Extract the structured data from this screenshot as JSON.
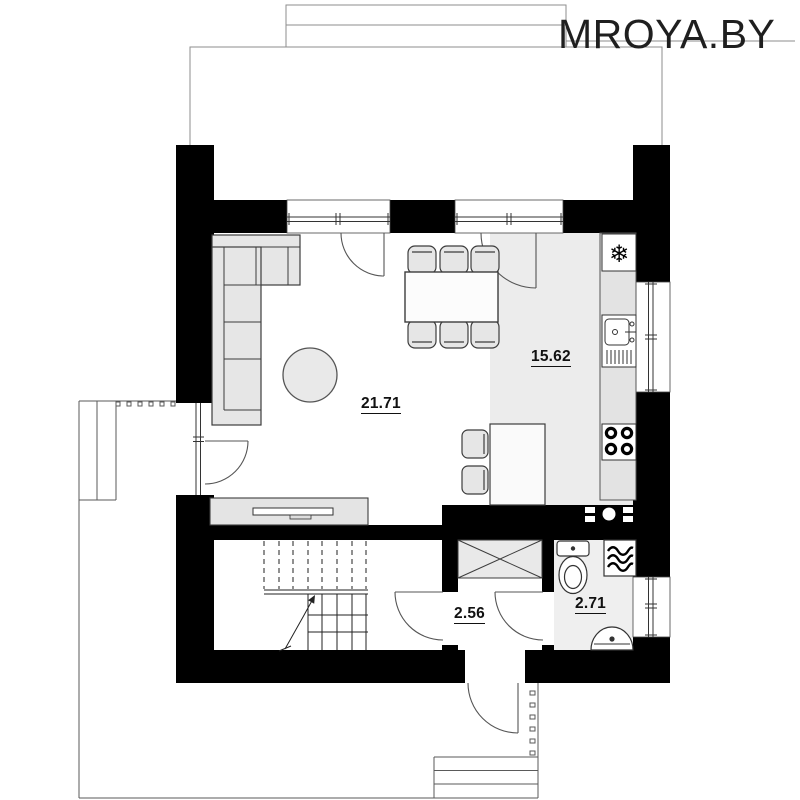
{
  "watermark": "MROYA.BY",
  "rooms": {
    "living_room": {
      "area": "21.71"
    },
    "kitchen": {
      "area": "15.62"
    },
    "hallway": {
      "area": "2.56"
    },
    "bathroom": {
      "area": "2.71"
    }
  },
  "icons": {
    "fridge": "❄"
  },
  "fixtures": [
    "corner-sofa",
    "coffee-table",
    "tv-stand",
    "dining-table",
    "dining-chairs",
    "kitchen-counter",
    "fridge",
    "kitchen-sink",
    "stove",
    "kitchen-island",
    "bar-stools",
    "wardrobe",
    "staircase",
    "toilet",
    "washing-machine",
    "washbasin",
    "vent-shaft",
    "entrance-steps",
    "terrace",
    "porch"
  ],
  "colors": {
    "wall": "#000000",
    "kitchen_floor": "#ececec",
    "bathroom_floor": "#efefef",
    "furniture_fill": "#e6e6e6",
    "furniture_stroke": "#3c3c3c",
    "roof_line": "#8e8e8e",
    "site_line": "#5a5a5a",
    "label_text": "#111111",
    "watermark_text": "#1f1f1f"
  }
}
